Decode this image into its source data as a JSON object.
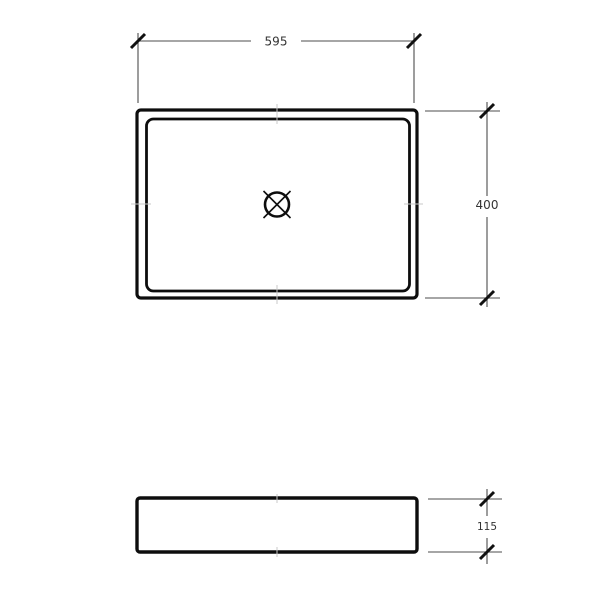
{
  "colors": {
    "background": "#ffffff",
    "outline": "#0d0d0d",
    "dimension_line": "#4d4d4d",
    "tick": "#111111",
    "text": "#333333",
    "center_mark": "#c8c8c8"
  },
  "dimensions": {
    "width": "595",
    "height": "400",
    "thickness": "115"
  },
  "icons": {
    "drain": "drain-outlet-icon"
  }
}
